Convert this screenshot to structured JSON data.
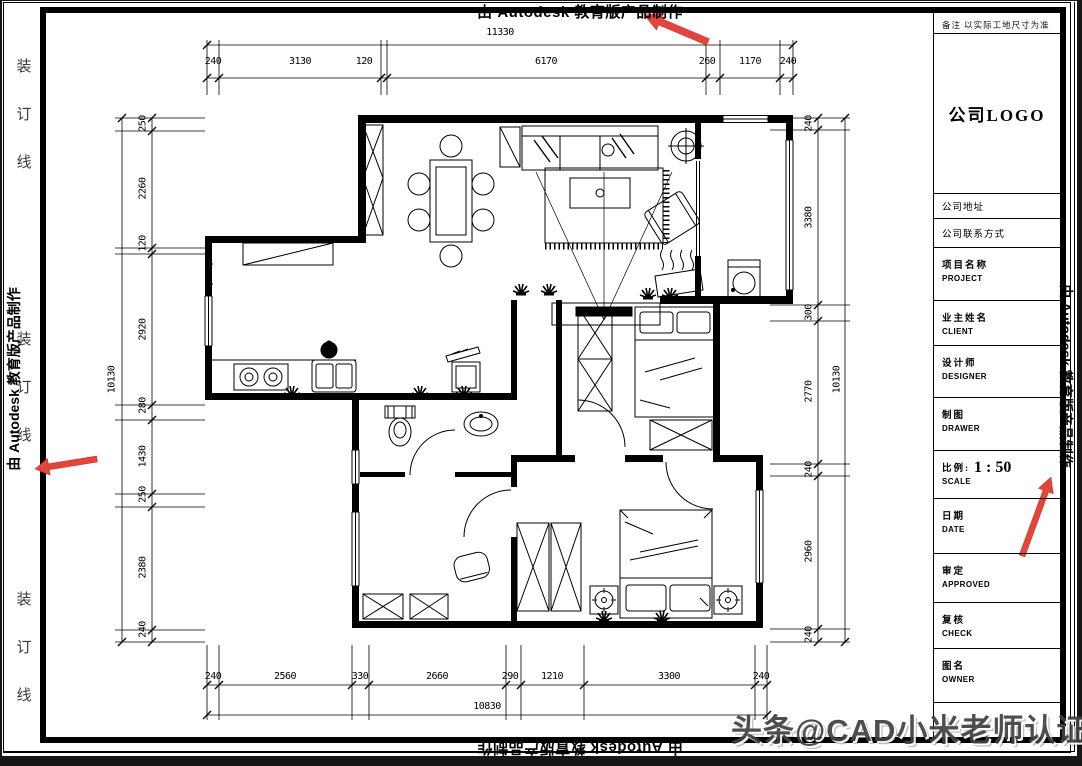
{
  "watermarks": {
    "autodesk": "由 Autodesk 教育版产品制作",
    "toutiao": "头条@CAD小米老师认证"
  },
  "binding_line": {
    "chars": [
      "装",
      "订",
      "线"
    ]
  },
  "title_block": {
    "note": "备注  以实际工地尺寸为准",
    "logo": "公司LOGO",
    "address": "公司地址",
    "contact": "公司联系方式",
    "rows": [
      {
        "cn": "项目名称",
        "en": "PROJECT"
      },
      {
        "cn": "业主姓名",
        "en": "CLIENT"
      },
      {
        "cn": "设计师",
        "en": "DESIGNER"
      },
      {
        "cn": "制图",
        "en": "DRAWER"
      },
      {
        "cn": "比例:",
        "en": "SCALE",
        "value": "1 : 50"
      },
      {
        "cn": "日期",
        "en": "DATE"
      },
      {
        "cn": "审定",
        "en": "APPROVED"
      },
      {
        "cn": "复核",
        "en": "CHECK"
      },
      {
        "cn": "图名",
        "en": "OWNER"
      }
    ]
  },
  "dims": {
    "top_total": "11330",
    "top": [
      "240",
      "3130",
      "120",
      "6170",
      "260",
      "1170",
      "240"
    ],
    "left_total": "10130",
    "left": [
      "250",
      "2260",
      "120",
      "2920",
      "280",
      "1430",
      "250",
      "2380",
      "240"
    ],
    "right_total": "10130",
    "right": [
      "240",
      "3380",
      "300",
      "2770",
      "240",
      "2960",
      "240"
    ],
    "bottom_total": "10830",
    "bottom": [
      "240",
      "2560",
      "330",
      "2660",
      "290",
      "1210",
      "3300",
      "240"
    ]
  },
  "colors": {
    "arrow_red": "#e2453a",
    "paper": "#ffffff",
    "line": "#000000"
  }
}
